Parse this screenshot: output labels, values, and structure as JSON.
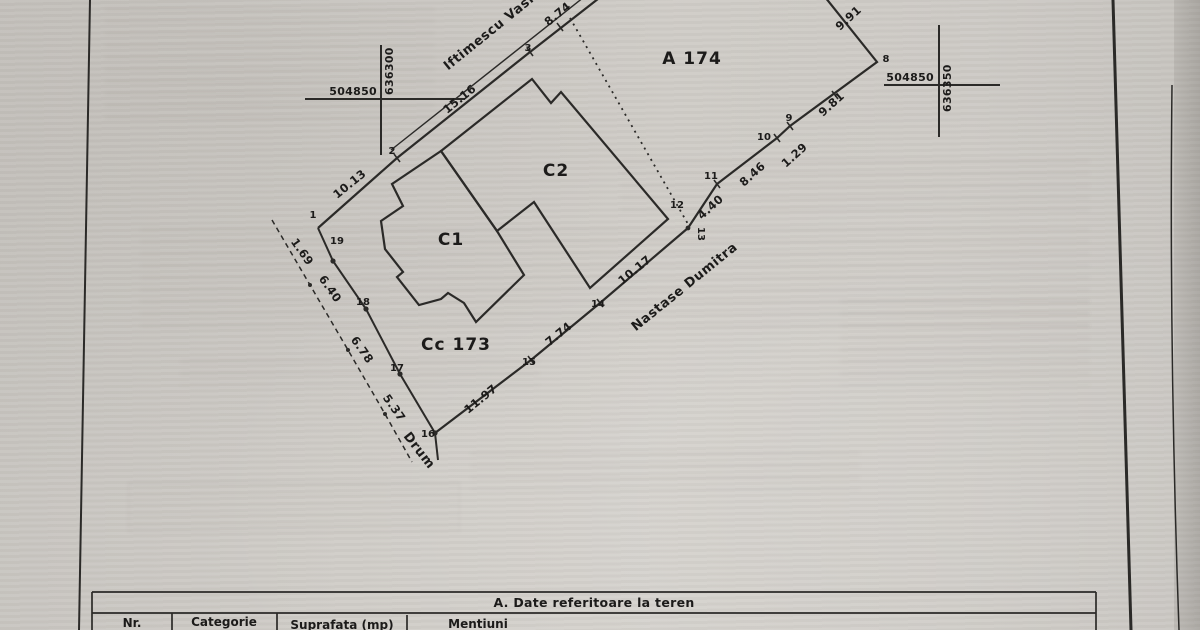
{
  "plan": {
    "streets": {
      "top": "Iftimescu Vasile",
      "bottom": "Nastase Dumitra",
      "left": "Drum"
    },
    "zones": {
      "field": "A 174",
      "courtyard": "Cc 173",
      "building_c1": "C1",
      "building_c2": "C2"
    },
    "crosses": {
      "left": {
        "east": "504850",
        "north": "636300"
      },
      "right": {
        "east": "504850",
        "north": "636350"
      }
    },
    "points": {
      "p1": "1",
      "p2": "2",
      "p3": "3",
      "p8": "8",
      "p9": "9",
      "p10": "10",
      "p11": "11",
      "p12": "12",
      "p13": "13",
      "p14": "14",
      "p15": "15",
      "p16": "16",
      "p17": "17",
      "p18": "18",
      "p19": "19"
    },
    "measurements": {
      "m1_2": "10.13",
      "m2_3": "15.16",
      "m3_4": "8.74",
      "m7_8": "9.91",
      "m8_9": "9.81",
      "m9_10": "1.29",
      "m10_11": "8.46",
      "m11_13": "4.40",
      "m13_14": "10.17",
      "m14_15": "7.74",
      "m15_16": "11.97",
      "m16_17": "5.37",
      "m17_18": "6.78",
      "m18_19": "6.40",
      "m19_1": "1.69"
    }
  },
  "table": {
    "section_title": "A. Date referitoare la teren",
    "columns": {
      "nr": "Nr.",
      "categorie": "Categorie",
      "suprafata": "Suprafata (mp)",
      "mentiuni": "Mentiuni"
    }
  }
}
